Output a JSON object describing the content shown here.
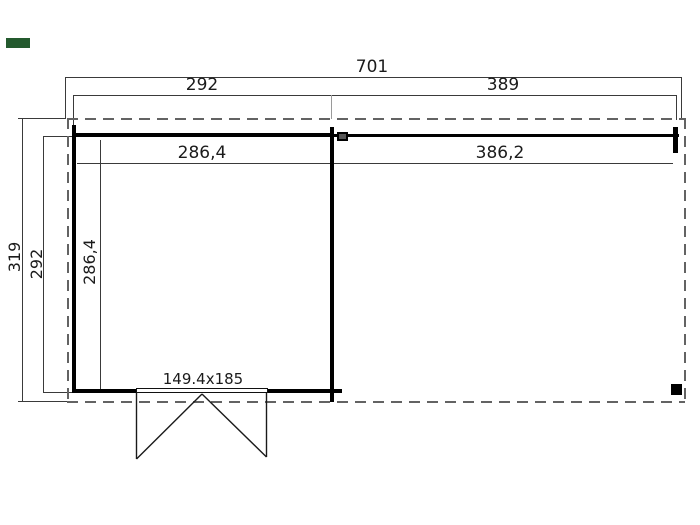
{
  "labels": {
    "total_width": "701",
    "cabin_width": "292",
    "canopy_width": "389",
    "cabin_inner_width": "286,4",
    "canopy_inner_width": "386,2",
    "total_depth": "319",
    "cabin_depth": "292",
    "cabin_inner_depth": "286,4",
    "door_size": "149.4x185"
  },
  "colors": {
    "background": "#ffffff",
    "wall": "#000000",
    "dimension_line": "#3a3a3a",
    "dashed_roof_outline": "#636363",
    "text": "#1b1b1b",
    "brand_marker_green": "#245a2e"
  }
}
